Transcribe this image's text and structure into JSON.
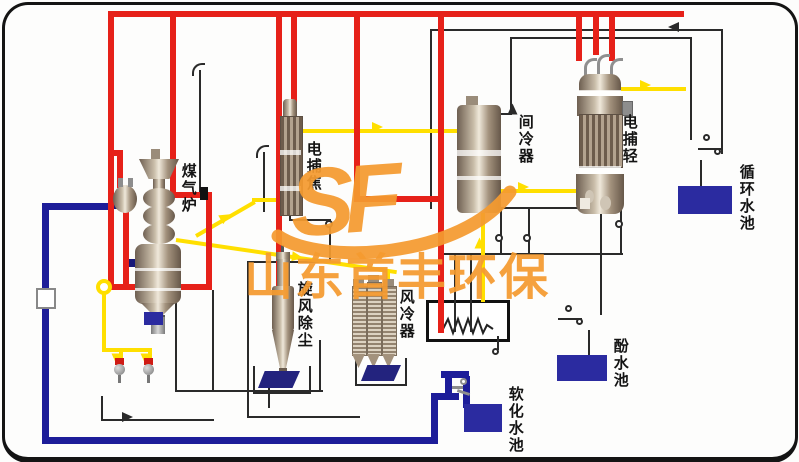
{
  "watermark": {
    "logo": "SF",
    "text": "山东首丰环保",
    "color": "#f59b30"
  },
  "equipment": {
    "furnace": "煤气炉",
    "ep_tar": "电捕焦",
    "intercooler": "间冷器",
    "ep_light": "电捕轻",
    "cyclone": "旋风除尘",
    "air_cooler": "风冷器"
  },
  "tanks": {
    "circulating": "循环水池",
    "phenol": "酚水池",
    "softened": "软化水池"
  },
  "colors": {
    "gas_line": "#ffdf00",
    "hot_gas_line": "#e62119",
    "water_line": "#1d1d99",
    "tank_fill": "#2b2ba0",
    "drain_line": "#2a2a2a",
    "watermark": "#f59b30"
  }
}
